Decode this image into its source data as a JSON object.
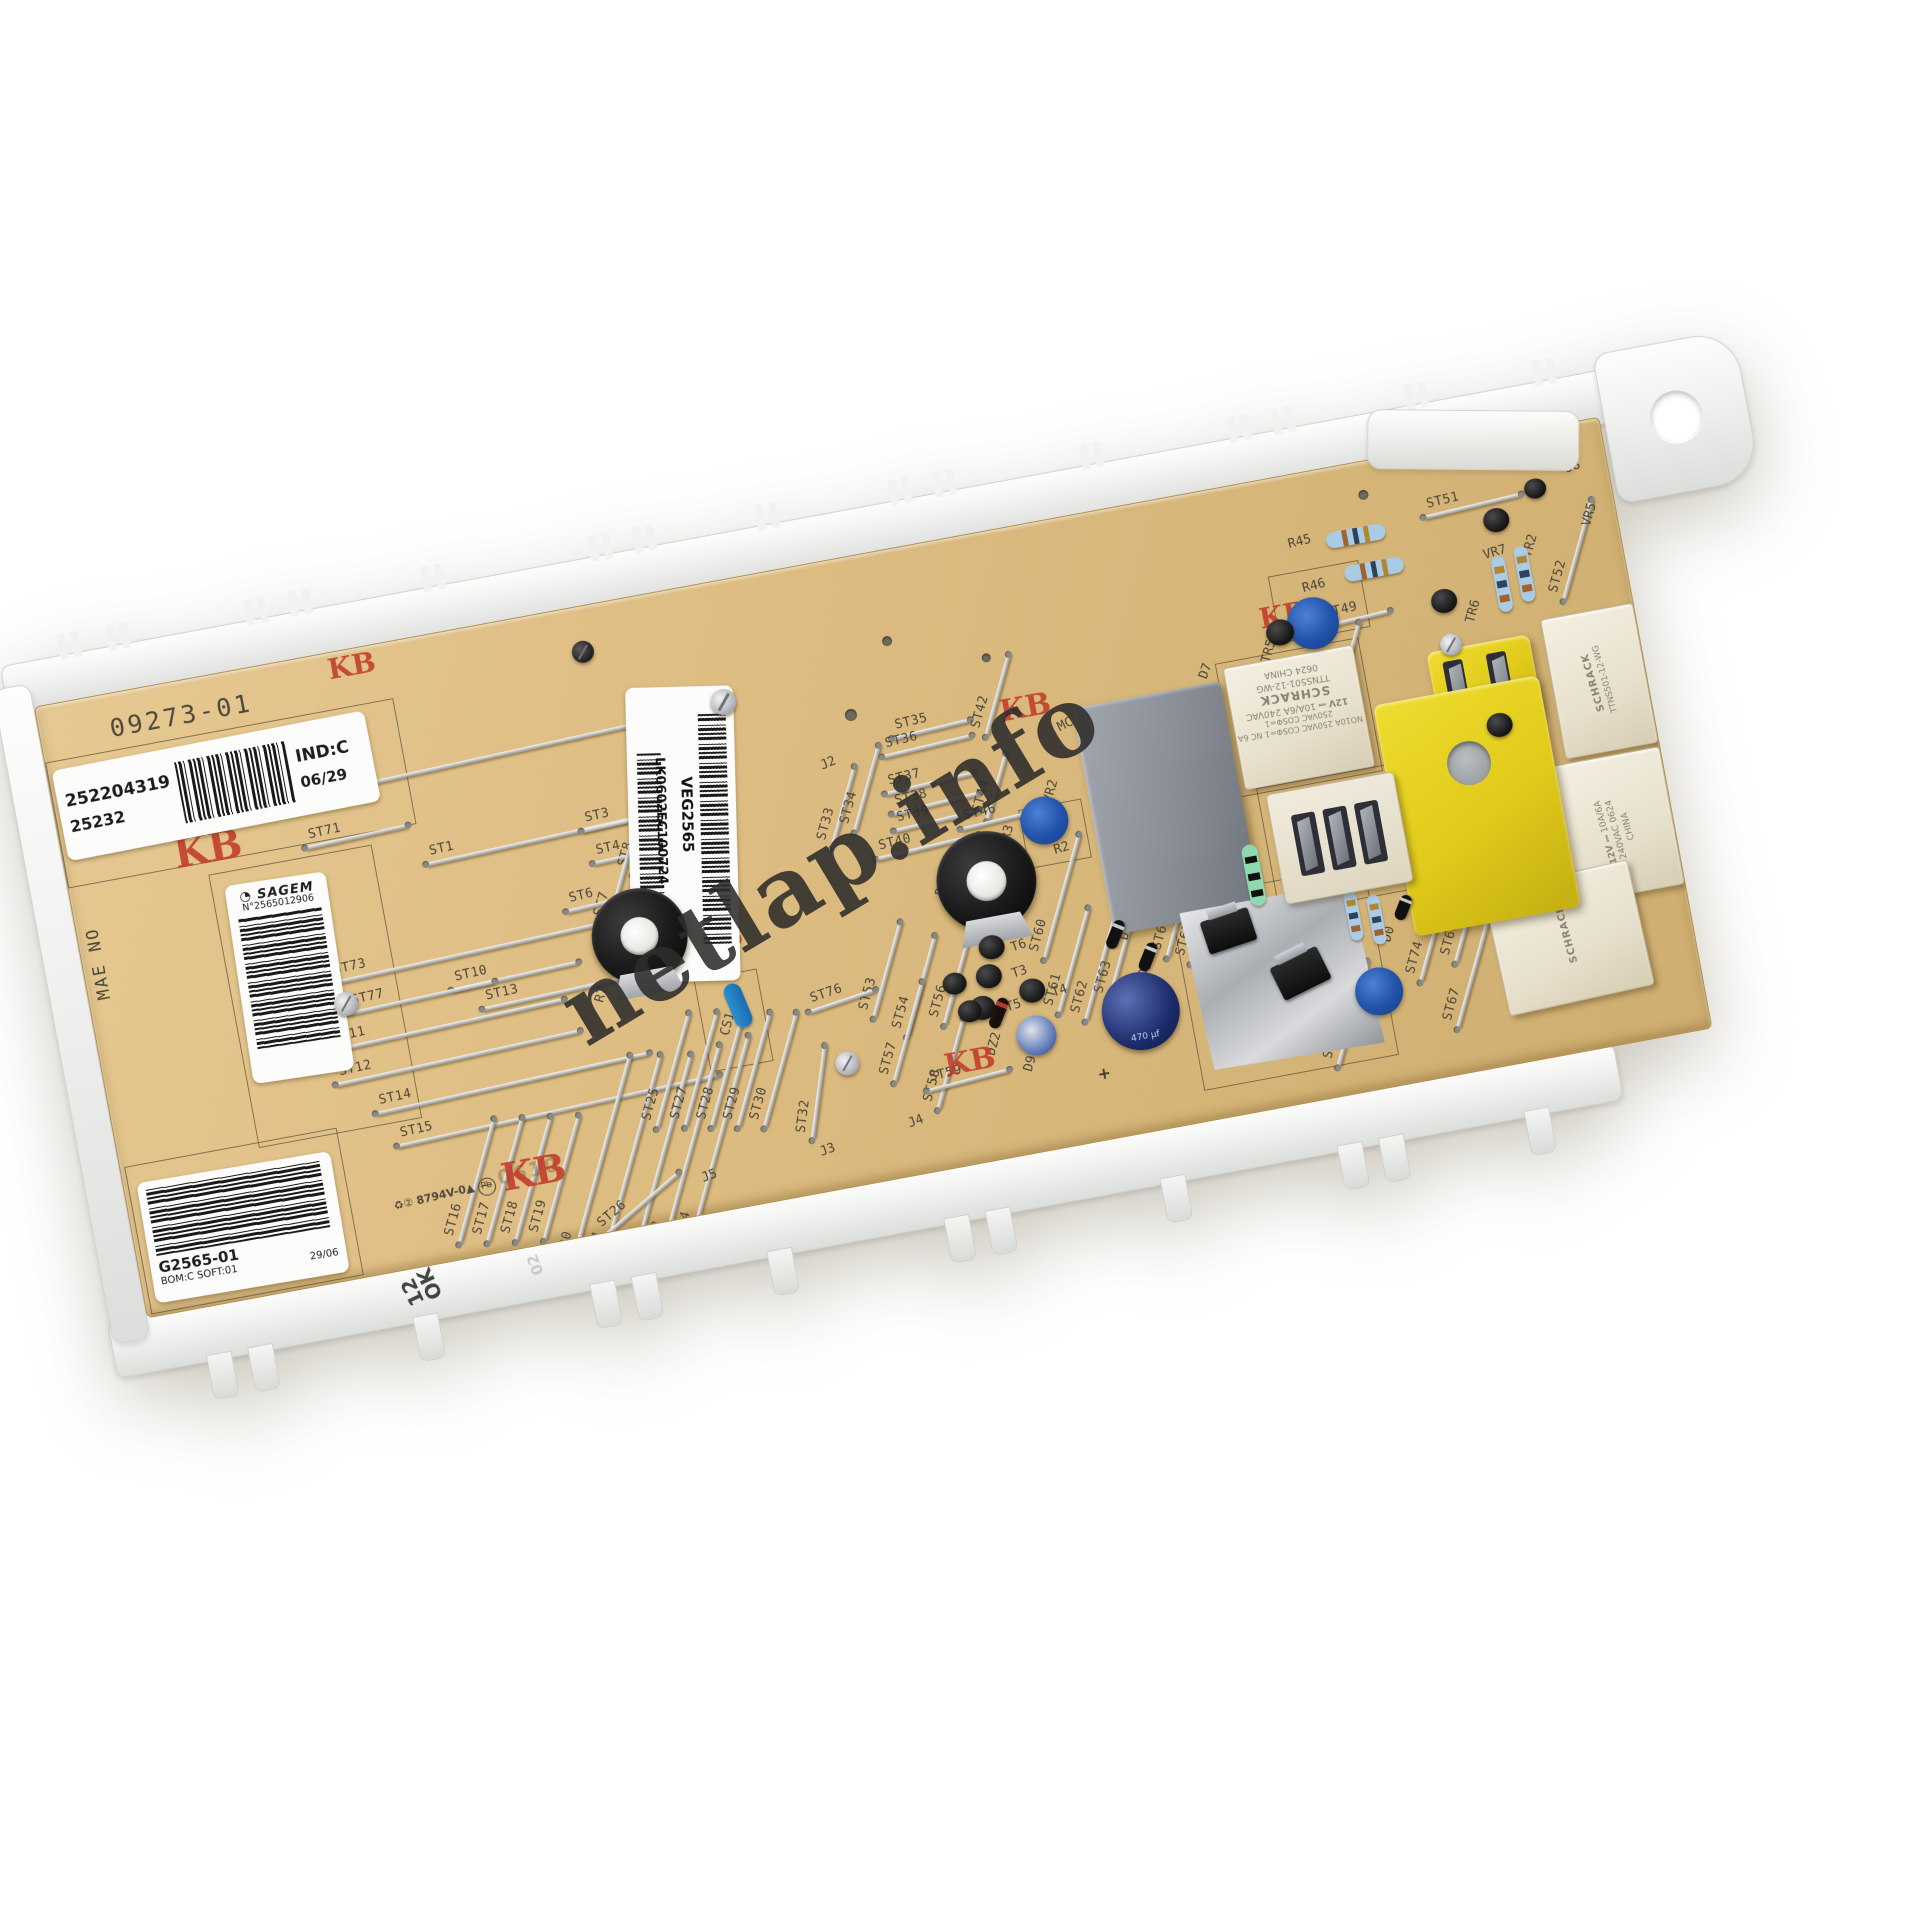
{
  "watermark": {
    "text": "netlap.info"
  },
  "silkscreen": {
    "board_id": "09273-01",
    "side_text": "MAE NO",
    "stamp": "KB",
    "cert": "8794V-0",
    "cert_triangle": "▲",
    "recycle": "♻②",
    "pb": "Pb",
    "faint_code": "0610",
    "plus": "+",
    "cap_value": "470 µf"
  },
  "stickers": {
    "id_label": {
      "number": "252204319",
      "sub": "25232",
      "ind": "IND:C",
      "date": "06/29"
    },
    "center_label": {
      "code": "VEG2565",
      "serial": "LK0602EC100724"
    },
    "sagem_label": {
      "brand": "SAGEM",
      "logo": "◔",
      "number": "N°2565012906"
    },
    "type_label": {
      "part": "G2565-01",
      "bom": "BOM:C SOFT:01",
      "date": "29/06"
    }
  },
  "frame": {
    "stamp_line1": "12",
    "stamp_line2": "OK",
    "stamp_code": "02"
  },
  "relays": {
    "brand": "SCHRACK",
    "model": "TTNS501-12-WG",
    "coil": "12V ⎓",
    "rating": "10A/6A",
    "voltage": "240VAC",
    "origin": "CHINA",
    "datecode": "0624",
    "cert_line": "NO10A 250VAC COSΦ=1  NC 6A 250VAC COSΦ=1"
  },
  "jumpers": [
    {
      "l": "ST72",
      "x": 418,
      "y": 130,
      "len": 330,
      "r": -2
    },
    {
      "l": "ST71",
      "x": 292,
      "y": 184,
      "len": 105,
      "r": -2
    },
    {
      "l": "ST1",
      "x": 468,
      "y": 220,
      "len": 225,
      "r": -2
    },
    {
      "l": "ST3",
      "x": 560,
      "y": 218,
      "len": 90,
      "r": -2
    },
    {
      "l": "ST4",
      "x": 565,
      "y": 252,
      "len": 90,
      "r": -2
    },
    {
      "l": "ST8",
      "x": 588,
      "y": 209,
      "len": 140,
      "r": -64
    },
    {
      "l": "ST7",
      "x": 553,
      "y": 258,
      "len": 130,
      "r": -64
    },
    {
      "l": "ST9",
      "x": 621,
      "y": 278,
      "len": 140,
      "r": -64
    },
    {
      "l": "ST6",
      "x": 560,
      "y": 292,
      "len": 150,
      "r": -3
    },
    {
      "l": "ST73",
      "x": 400,
      "y": 318,
      "len": 320,
      "r": -2
    },
    {
      "l": "ST10",
      "x": 423,
      "y": 350,
      "len": 130,
      "r": -2
    },
    {
      "l": "ST77",
      "x": 327,
      "y": 354,
      "len": 150,
      "r": -2
    },
    {
      "l": "ST13",
      "x": 460,
      "y": 374,
      "len": 150,
      "r": -2
    },
    {
      "l": "ST11",
      "x": 347,
      "y": 386,
      "len": 240,
      "r": -2
    },
    {
      "l": "ST12",
      "x": 352,
      "y": 420,
      "len": 250,
      "r": -2
    },
    {
      "l": "ST14",
      "x": 401,
      "y": 455,
      "len": 280,
      "r": -2
    },
    {
      "l": "ST15",
      "x": 441,
      "y": 490,
      "len": 330,
      "r": -2
    },
    {
      "l": "ST16",
      "x": 348,
      "y": 545,
      "len": 130,
      "r": -64
    },
    {
      "l": "ST17",
      "x": 376,
      "y": 549,
      "len": 130,
      "r": -64
    },
    {
      "l": "ST18",
      "x": 404,
      "y": 553,
      "len": 130,
      "r": -64
    },
    {
      "l": "ST19",
      "x": 432,
      "y": 557,
      "len": 130,
      "r": -64
    },
    {
      "l": "ST20",
      "x": 472,
      "y": 550,
      "len": 225,
      "r": -64
    },
    {
      "l": "ST21",
      "x": 502,
      "y": 555,
      "len": 225,
      "r": -64
    },
    {
      "l": "ST22",
      "x": 532,
      "y": 560,
      "len": 225,
      "r": -64
    },
    {
      "l": "ST23",
      "x": 562,
      "y": 556,
      "len": 225,
      "r": -64
    },
    {
      "l": "ST24",
      "x": 592,
      "y": 552,
      "len": 225,
      "r": -64
    },
    {
      "l": "ST26",
      "x": 505,
      "y": 598,
      "len": 100,
      "r": -30
    },
    {
      "l": "ST25",
      "x": 561,
      "y": 472,
      "len": 120,
      "r": -64
    },
    {
      "l": "ST27",
      "x": 589,
      "y": 476,
      "len": 120,
      "r": -64
    },
    {
      "l": "ST28",
      "x": 615,
      "y": 481,
      "len": 120,
      "r": -64
    },
    {
      "l": "ST29",
      "x": 641,
      "y": 486,
      "len": 120,
      "r": -64
    },
    {
      "l": "ST30",
      "x": 667,
      "y": 491,
      "len": 120,
      "r": -64
    },
    {
      "l": "ST32",
      "x": 700,
      "y": 520,
      "len": 95,
      "r": -72
    },
    {
      "l": "ST33",
      "x": 776,
      "y": 244,
      "len": 85,
      "r": -64
    },
    {
      "l": "ST34",
      "x": 803,
      "y": 230,
      "len": 90,
      "r": -64
    },
    {
      "l": "ST35",
      "x": 877,
      "y": 183,
      "len": 80,
      "r": -3
    },
    {
      "l": "ST36",
      "x": 870,
      "y": 199,
      "len": 92,
      "r": -3
    },
    {
      "l": "ST37",
      "x": 866,
      "y": 236,
      "len": 92,
      "r": -3
    },
    {
      "l": "ST38",
      "x": 868,
      "y": 257,
      "len": 90,
      "r": -3
    },
    {
      "l": "ST39",
      "x": 867,
      "y": 274,
      "len": 90,
      "r": -3
    },
    {
      "l": "ST40",
      "x": 851,
      "y": 298,
      "len": 105,
      "r": -3
    },
    {
      "l": "ST42",
      "x": 948,
      "y": 162,
      "len": 85,
      "r": -64
    },
    {
      "l": "ST44",
      "x": 931,
      "y": 252,
      "len": 70,
      "r": -64
    },
    {
      "l": "ST46",
      "x": 923,
      "y": 285,
      "len": 70,
      "r": -3
    },
    {
      "l": "ST60",
      "x": 975,
      "y": 372,
      "len": 130,
      "r": -64
    },
    {
      "l": "ST53",
      "x": 790,
      "y": 412,
      "len": 100,
      "r": -64
    },
    {
      "l": "ST54",
      "x": 820,
      "y": 434,
      "len": 105,
      "r": -64
    },
    {
      "l": "ST56",
      "x": 858,
      "y": 432,
      "len": 100,
      "r": -64
    },
    {
      "l": "ST57",
      "x": 799,
      "y": 477,
      "len": 105,
      "r": -64
    },
    {
      "l": "ST58",
      "x": 835,
      "y": 516,
      "len": 95,
      "r": -64
    },
    {
      "l": "ST59",
      "x": 849,
      "y": 535,
      "len": 85,
      "r": -4
    },
    {
      "l": "ST76",
      "x": 740,
      "y": 434,
      "len": 70,
      "r": -8
    },
    {
      "l": "ST61",
      "x": 975,
      "y": 437,
      "len": 110,
      "r": -64
    },
    {
      "l": "ST62",
      "x": 1000,
      "y": 449,
      "len": 110,
      "r": -64
    },
    {
      "l": "ST63",
      "x": 1025,
      "y": 436,
      "len": 105,
      "r": -64
    },
    {
      "l": "ST64",
      "x": 1090,
      "y": 404,
      "len": 105,
      "r": -64
    },
    {
      "l": "ST65",
      "x": 1112,
      "y": 414,
      "len": 105,
      "r": -64
    },
    {
      "l": "ST49",
      "x": 1315,
      "y": 152,
      "len": 70,
      "r": -3
    },
    {
      "l": "ST48",
      "x": 1300,
      "y": 192,
      "len": 80,
      "r": -64
    },
    {
      "l": "ST51",
      "x": 1450,
      "y": 62,
      "len": 100,
      "r": -3
    },
    {
      "l": "ST52",
      "x": 1545,
      "y": 125,
      "len": 105,
      "r": -64
    },
    {
      "l": "ST66",
      "x": 1240,
      "y": 540,
      "len": 110,
      "r": -64
    },
    {
      "l": "ST74",
      "x": 1330,
      "y": 485,
      "len": 80,
      "r": -64
    },
    {
      "l": "ST67",
      "x": 1365,
      "y": 522,
      "len": 115,
      "r": -64
    },
    {
      "l": "ST68",
      "x": 1372,
      "y": 464,
      "len": 100,
      "r": -64
    }
  ],
  "refdes": [
    {
      "l": "J2",
      "x": 762,
      "y": 192,
      "r": -12
    },
    {
      "l": "J3",
      "x": 691,
      "y": 572,
      "r": -10
    },
    {
      "l": "J4",
      "x": 783,
      "y": 560,
      "r": -10
    },
    {
      "l": "J5",
      "x": 570,
      "y": 576,
      "r": -10
    },
    {
      "l": "J8",
      "x": 1548,
      "y": 36,
      "r": -10
    },
    {
      "l": "R7",
      "x": 497,
      "y": 378,
      "r": -64
    },
    {
      "l": "R3",
      "x": 926,
      "y": 293,
      "r": -64
    },
    {
      "l": "R22",
      "x": 849,
      "y": 332,
      "r": -64
    },
    {
      "l": "R2",
      "x": 976,
      "y": 318,
      "r": -6
    },
    {
      "l": "R1",
      "x": 1150,
      "y": 398,
      "r": -64
    },
    {
      "l": "R45",
      "x": 1262,
      "y": 60,
      "r": -4
    },
    {
      "l": "R46",
      "x": 1268,
      "y": 106,
      "r": -4
    },
    {
      "l": "VR2",
      "x": 972,
      "y": 260,
      "r": -64
    },
    {
      "l": "VR3",
      "x": 1262,
      "y": 188,
      "r": -64
    },
    {
      "l": "VR7",
      "x": 1452,
      "y": 106,
      "r": -6
    },
    {
      "l": "VR6",
      "x": 1448,
      "y": 300,
      "r": -64
    },
    {
      "l": "VR5",
      "x": 1552,
      "y": 86,
      "r": -64
    },
    {
      "l": "VR1",
      "x": 1240,
      "y": 530,
      "r": -64
    },
    {
      "l": "TR5",
      "x": 1212,
      "y": 162,
      "r": -64
    },
    {
      "l": "TR6",
      "x": 1420,
      "y": 160,
      "r": -64
    },
    {
      "l": "TR2",
      "x": 1488,
      "y": 106,
      "r": -64
    },
    {
      "l": "MC2",
      "x": 1002,
      "y": 196,
      "r": -16
    },
    {
      "l": "MC3",
      "x": 1235,
      "y": 396,
      "r": -64
    },
    {
      "l": "CS1",
      "x": 612,
      "y": 430,
      "r": -64
    },
    {
      "l": "DZ2",
      "x": 870,
      "y": 498,
      "r": -64
    },
    {
      "l": "D9",
      "x": 906,
      "y": 524,
      "r": -64
    },
    {
      "l": "D2",
      "x": 1024,
      "y": 412,
      "r": -64
    },
    {
      "l": "D1",
      "x": 1036,
      "y": 452,
      "r": -64
    },
    {
      "l": "D0",
      "x": 1282,
      "y": 462,
      "r": -64
    },
    {
      "l": "D7",
      "x": 1150,
      "y": 170,
      "r": -60
    },
    {
      "l": "D8",
      "x": 1388,
      "y": 436,
      "r": -64
    },
    {
      "l": "T6",
      "x": 916,
      "y": 406,
      "r": -8
    },
    {
      "l": "T3",
      "x": 912,
      "y": 432,
      "r": -8
    },
    {
      "l": "T5",
      "x": 900,
      "y": 464,
      "r": -8
    },
    {
      "l": "T4",
      "x": 948,
      "y": 458,
      "r": -8
    },
    {
      "l": "RL2",
      "x": 1320,
      "y": 444,
      "r": -64
    }
  ]
}
